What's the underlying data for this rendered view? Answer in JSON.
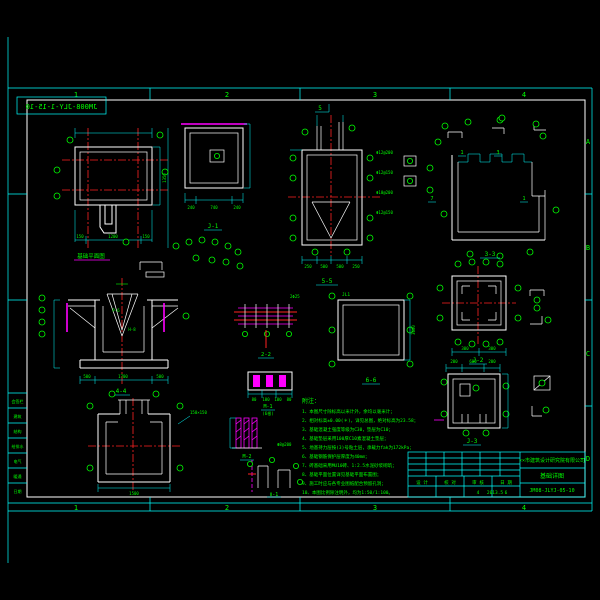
{
  "sheet": {
    "zones_top": [
      "1",
      "2",
      "3",
      "4"
    ],
    "zones_bottom": [
      "1",
      "2",
      "3",
      "4"
    ],
    "zones_right": [
      "A",
      "B",
      "C",
      "D"
    ],
    "stamp": "JM008-JLY-1-15-10"
  },
  "sign_column": {
    "rows": [
      "会签栏",
      "建筑",
      "结构",
      "给排水",
      "电气",
      "暖通",
      "日期"
    ]
  },
  "views": {
    "plan": {
      "title": "基础平面图",
      "dims_bottom": [
        "150",
        "1200",
        "150"
      ],
      "dim_right": "1350"
    },
    "j1": {
      "title": "J-1",
      "dims": [
        "240",
        "740",
        "240"
      ]
    },
    "s5": {
      "title": "5-5",
      "mark": "5",
      "dims_bottom": [
        "250",
        "500",
        "500",
        "250"
      ],
      "bars": [
        "Φ12@200",
        "Φ12@150",
        "Φ10@200",
        "Φ12@150"
      ]
    },
    "s3": {
      "title": "3-3",
      "marks": [
        "1",
        "3",
        "7",
        "1"
      ]
    },
    "s4": {
      "title": "4-4",
      "labels": [
        "P-6",
        "H-8"
      ],
      "dims_bottom": [
        "500",
        "1700",
        "500"
      ]
    },
    "s2": {
      "title": "2-2",
      "bar": "2Φ25"
    },
    "s6": {
      "title": "6-6",
      "tag": "JL1",
      "dim": "3600"
    },
    "j2": {
      "title": "J-2",
      "dims": [
        "300",
        "300"
      ]
    },
    "j3": {
      "title": "J-3",
      "dims_top": [
        "200",
        "600",
        "200"
      ]
    },
    "s1": {
      "dim_bottom": "1500",
      "note": "150×150"
    },
    "m1": {
      "title": "M-1",
      "sub": "(6根)",
      "dims": [
        "80",
        "100",
        "100",
        "80"
      ]
    },
    "m2": {
      "title": "M-2",
      "bar": "Φ8@200"
    },
    "ii1": {
      "title": "Ⅱ-1"
    }
  },
  "notes": {
    "header": "附注：",
    "items": [
      "1、本图尺寸除标高以米计外，余均以毫米计；",
      "2、相对标高±0.00(＊)，详见总图，绝对标高为23.58；",
      "3、基础混凝土强度等级为C30，垫层为C10；",
      "4、基础垫层采用100厚C10素混凝土垫层；",
      "5、地基持力层按(3)号粘土层，承载力fak为172kPa；",
      "6、基础钢筋保护层厚度为40mm；",
      "7、砖基础采用MU10砖、1:2.5水泥砂浆砌筑；",
      "8、基础平面位置详见基础平面布置图；",
      "9、施工时应与各专业图纸配合预留孔洞；",
      "10、本图比例除注明外，均为1:50/1:100。"
    ]
  },
  "title_block": {
    "company": "××市建筑设计研究院有限公司",
    "drawing_title": "基础详图",
    "drawing_no": "JM08-JLYJ-05-10",
    "fields": [
      {
        "label": "设 计",
        "value": ""
      },
      {
        "label": "校 对",
        "value": ""
      },
      {
        "label": "审 核",
        "value": ""
      },
      {
        "label": "日 期",
        "value": "2013.5"
      }
    ],
    "sheet_no": "4",
    "sheet_total": "6"
  }
}
